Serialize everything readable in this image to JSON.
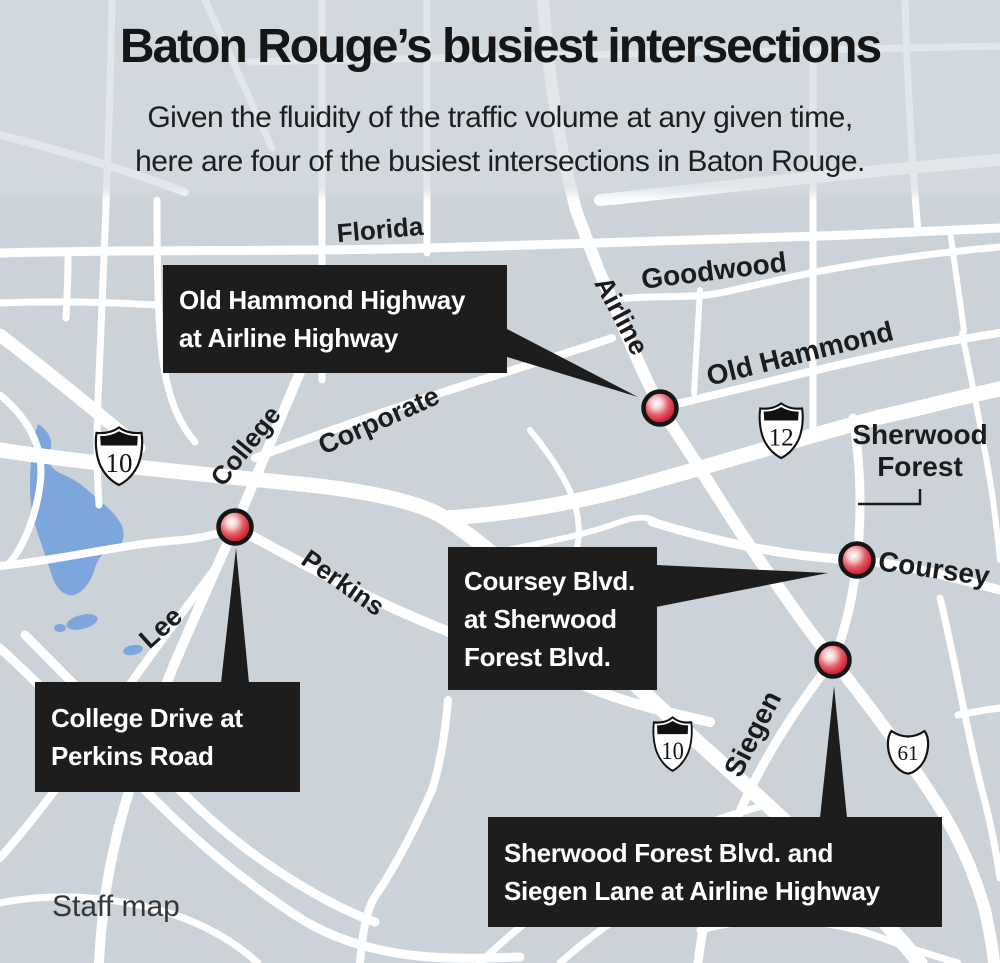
{
  "header": {
    "title": "Baton Rouge’s busiest intersections",
    "subtitle_lines": [
      "Given the fluidity of the traffic volume at any given time,",
      "here are four of the busiest intersections in Baton Rouge."
    ]
  },
  "map": {
    "street_labels": [
      {
        "text": "Florida"
      },
      {
        "text": "Airline"
      },
      {
        "text": "Goodwood"
      },
      {
        "text": "Old Hammond"
      },
      {
        "text": "Corporate"
      },
      {
        "text": "College"
      },
      {
        "text": "Perkins"
      },
      {
        "text": "Lee"
      },
      {
        "text": "Coursey"
      },
      {
        "text": "Siegen"
      }
    ],
    "area_label": {
      "lines": [
        "Sherwood",
        "Forest"
      ]
    },
    "shields": [
      {
        "type": "interstate",
        "number": "10"
      },
      {
        "type": "interstate",
        "number": "12"
      },
      {
        "type": "interstate",
        "number": "10"
      },
      {
        "type": "us-route",
        "number": "61"
      }
    ],
    "callouts": [
      {
        "lines": [
          "Old Hammond Highway",
          "at Airline Highway"
        ]
      },
      {
        "lines": [
          "College Drive at",
          "Perkins Road"
        ]
      },
      {
        "lines": [
          "Coursey Blvd.",
          "at Sherwood",
          "Forest Blvd."
        ]
      },
      {
        "lines": [
          "Sherwood Forest Blvd. and",
          "Siegen Lane at Airline Highway"
        ]
      }
    ],
    "colors": {
      "map_background": "#cbd3d9",
      "road": "#ffffff",
      "water": "#7ca6dc",
      "callout_background": "#1d1d1d",
      "callout_text": "#ffffff",
      "marker_red": "#d02435",
      "marker_outline": "#161616",
      "label_text": "#1b1c1e"
    }
  },
  "credit": "Staff map"
}
